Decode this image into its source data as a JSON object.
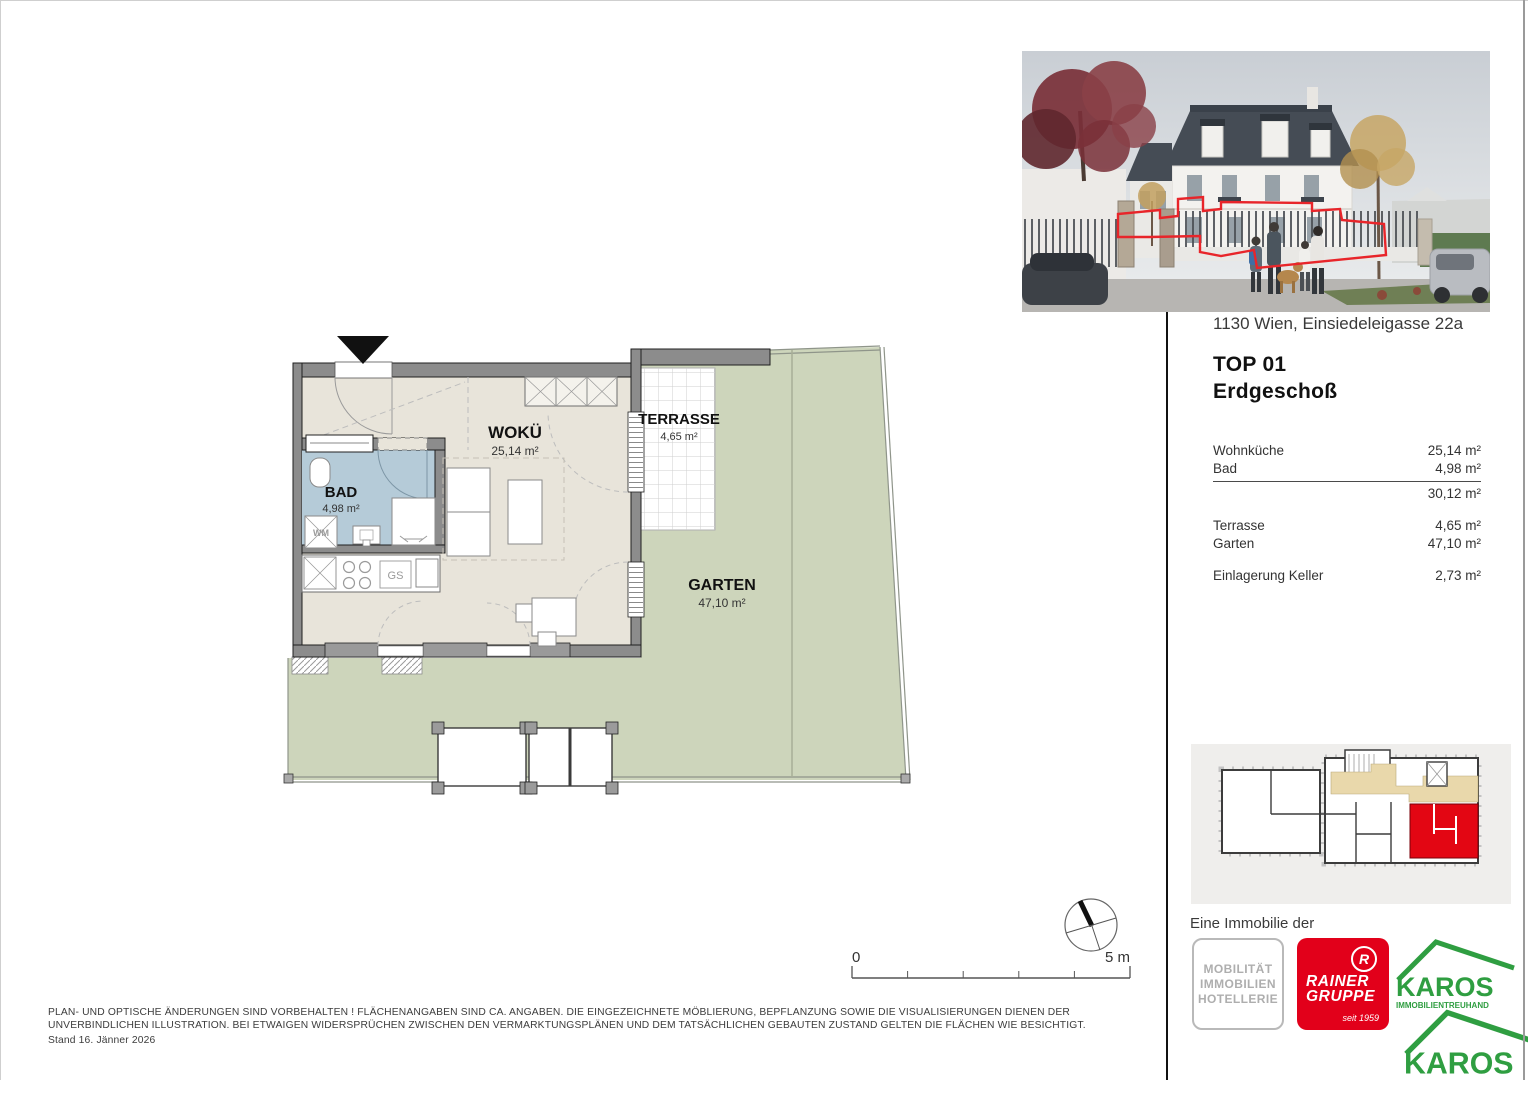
{
  "header": {
    "address": "1130 Wien, Einsiedeleigasse 22a",
    "unit": "TOP 01",
    "floor": "Erdgeschoß"
  },
  "area_table": {
    "interior": [
      {
        "label": "Wohnküche",
        "value": "25,14 m²"
      },
      {
        "label": "Bad",
        "value": "4,98 m²"
      }
    ],
    "interior_total": "30,12 m²",
    "exterior": [
      {
        "label": "Terrasse",
        "value": "4,65 m²"
      },
      {
        "label": "Garten",
        "value": "47,10 m²"
      }
    ],
    "extras": [
      {
        "label": "Einlagerung Keller",
        "value": "2,73 m²"
      }
    ]
  },
  "floorplan": {
    "rooms": [
      {
        "name": "WOKÜ",
        "area": "25,14 m²"
      },
      {
        "name": "BAD",
        "area": "4,98 m²"
      },
      {
        "name": "TERRASSE",
        "area": "4,65 m²"
      },
      {
        "name": "GARTEN",
        "area": "47,10 m²"
      }
    ],
    "fixtures": {
      "wm": "WM",
      "gs": "GS"
    }
  },
  "scale_bar": {
    "start": "0",
    "end": "5 m"
  },
  "branding": {
    "lead_in": "Eine Immobilie der",
    "mobilitaet_lines": [
      "MOBILITÄT",
      "IMMOBILIEN",
      "HOTELLERIE"
    ],
    "rainer": {
      "mark": "R",
      "name_line1": "RAINER",
      "name_line2": "GRUPPE",
      "tagline": "seit 1959"
    },
    "karos": {
      "name": "KAROS",
      "subtitle": "IMMOBILIENTREUHAND"
    }
  },
  "footer": {
    "disclaimer_line1": "PLAN- UND OPTISCHE ÄNDERUNGEN SIND VORBEHALTEN ! FLÄCHENANGABEN SIND CA. ANGABEN. DIE EINGEZEICHNETE MÖBLIERUNG, BEPFLANZUNG SOWIE DIE VISUALISIERUNGEN DIENEN DER",
    "disclaimer_line2": "UNVERBINDLICHEN ILLUSTRATION. BEI ETWAIGEN WIDERSPRÜCHEN ZWISCHEN DEN VERMARKTUNGSPLÄNEN UND DEM TATSÄCHLICHEN GEBAUTEN ZUSTAND GELTEN DIE FLÄCHEN WIE BESICHTIGT.",
    "stand": "Stand 16. Jänner 2026"
  },
  "colors": {
    "garden_green": "#cdd5bb",
    "floor_beige": "#e8e4da",
    "bath_blue": "#b5cbd8",
    "wall_gray": "#8c8c8c",
    "unit_red": "#e30613",
    "rainer_red": "#e2001a",
    "karos_green": "#2f9e41",
    "corridor_tan": "#e9d8ab"
  }
}
